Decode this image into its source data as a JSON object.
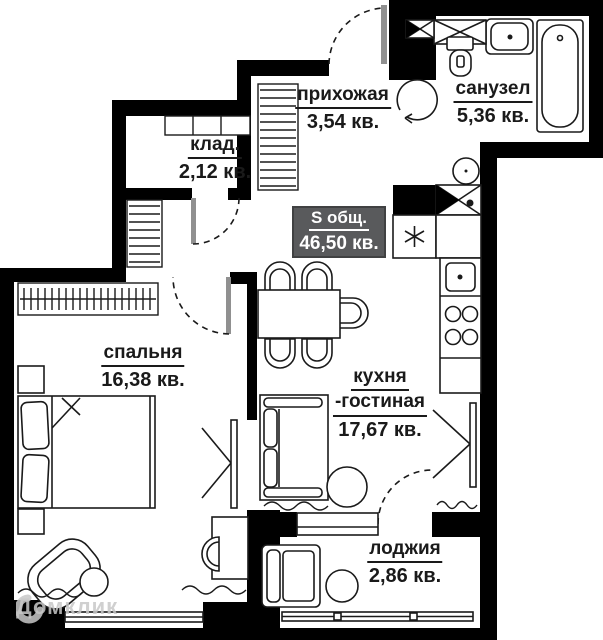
{
  "total_area_badge": {
    "label": "S общ.",
    "value": "46,50 кв."
  },
  "rooms": {
    "hallway": {
      "name": "прихожая",
      "area": "3,54 кв."
    },
    "bathroom": {
      "name": "санузел",
      "area": "5,36 кв."
    },
    "storage": {
      "name": "клад.",
      "area": "2,12 кв."
    },
    "bedroom": {
      "name": "спальня",
      "area": "16,38 кв."
    },
    "kitchen_living": {
      "name": "кухня",
      "name2": "-гостиная",
      "area": "17,67 кв."
    },
    "loggia": {
      "name": "лоджия",
      "area": "2,86 кв."
    }
  },
  "watermark": {
    "text": "Домклик"
  },
  "colors": {
    "walls": "#000000",
    "lines": "#1a1a1a",
    "background": "#ffffff",
    "badge_bg": "#595a5c",
    "badge_border": "#404142",
    "badge_text": "#ffffff",
    "door_leaf": "#909090",
    "watermark": "#c8c8c8"
  },
  "icons": {
    "bathtub": "bathtub-icon",
    "bath_sink": "sink-icon",
    "toilet": "toilet-icon",
    "washing_machine": "washing-machine-icon",
    "vent_shaft": "vent-shaft-icon",
    "boiler": "boiler-icon",
    "kitchen_sink": "kitchen-sink-icon",
    "stove": "stove-icon",
    "dining_table": "dining-table-icon",
    "chair": "chair-icon",
    "sofa": "sofa-icon",
    "coffee_table": "coffee-table-icon",
    "bed": "bed-icon",
    "wardrobe": "wardrobe-icon",
    "armchair": "armchair-icon",
    "desk": "desk-icon",
    "window": "window-icon",
    "door_swing": "door-swing-icon",
    "radiator": "radiator-squiggle-icon"
  }
}
